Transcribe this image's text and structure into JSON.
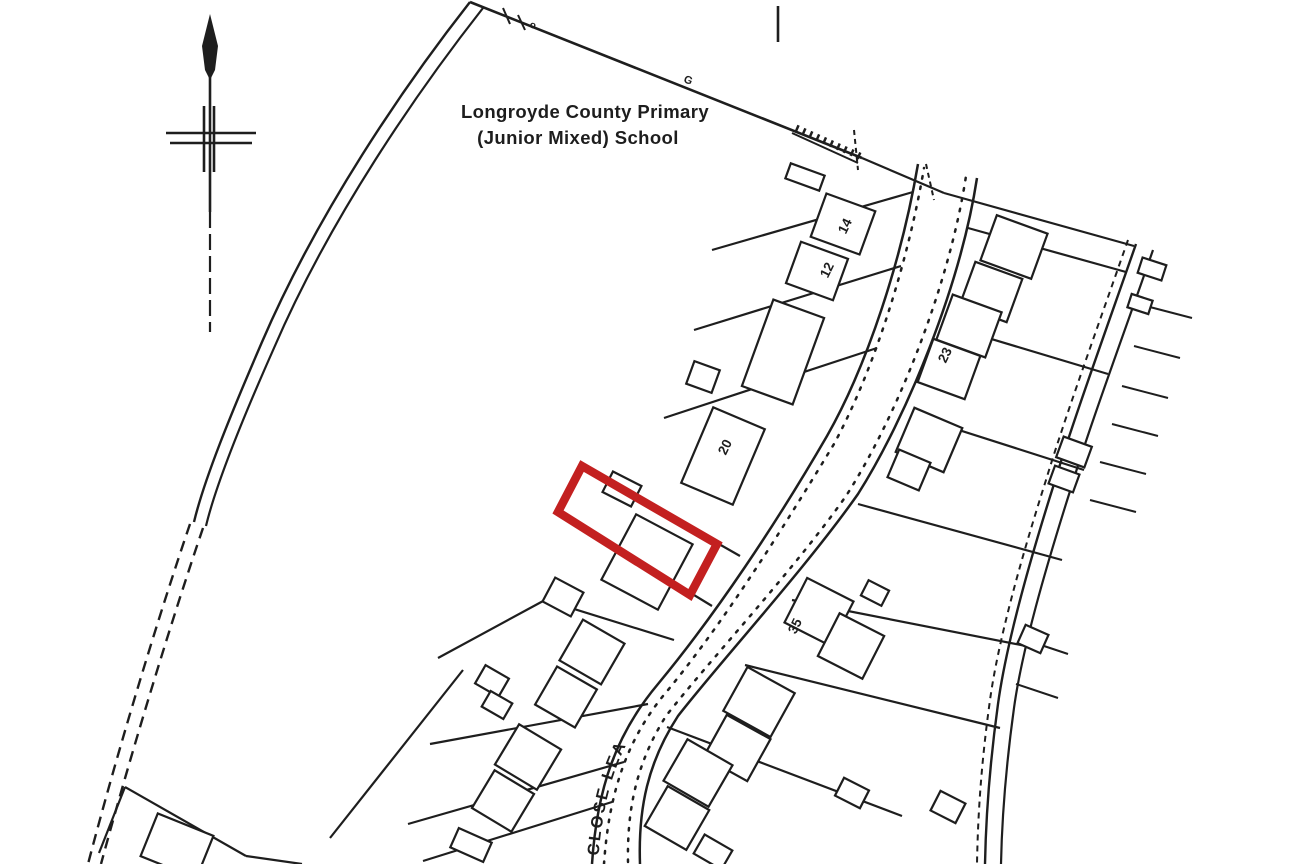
{
  "colors": {
    "ink": "#1e1e1e",
    "paper": "#ffffff",
    "highlight_red": "#c32020"
  },
  "map": {
    "school_label": {
      "line1": "Longroyde County Primary",
      "line2": "(Junior Mixed) School"
    },
    "street_label": {
      "text": "CLOSE LEA",
      "path": "M 598,862 C 603,800 614,758 645,714 C 665,689 688,667 712,649",
      "start_offset": 6
    },
    "boundary_marks": [
      {
        "text": "o",
        "x": 529,
        "y": 27,
        "rot": 20,
        "size": 10
      },
      {
        "text": "G",
        "x": 683,
        "y": 82,
        "rot": 20,
        "size": 11
      }
    ],
    "plot_numbers": [
      {
        "text": "14",
        "x": 849,
        "y": 228,
        "rot": -64
      },
      {
        "text": "12",
        "x": 831,
        "y": 272,
        "rot": -64
      },
      {
        "text": "23",
        "x": 949,
        "y": 357,
        "rot": -64
      },
      {
        "text": "20",
        "x": 729,
        "y": 449,
        "rot": -64
      },
      {
        "text": "35",
        "x": 799,
        "y": 628,
        "rot": -64
      }
    ],
    "highlight_plot": {
      "points": "582,466 717,544 690,595 558,512",
      "stroke_width": 8.5
    },
    "north_arrow": {
      "head_points": "210,14 218,46 215,70 210,80 205,70 202,46",
      "strokes": [
        {
          "name": "north-arrow-stem",
          "d": "M 210,58 L 210,212",
          "w": 2.6
        },
        {
          "name": "north-arrow-stem-lower",
          "d": "M 210,212 L 210,332",
          "w": 2.2,
          "dash": "16 6"
        },
        {
          "name": "north-arrow-cross",
          "d": "M 166,133 L 256,133",
          "w": 2.6
        },
        {
          "name": "north-arrow-cross",
          "d": "M 170,143 L 252,143",
          "w": 2.6
        },
        {
          "name": "north-arrow-cross",
          "d": "M 204,106 L 204,172",
          "w": 2.6
        },
        {
          "name": "north-arrow-cross",
          "d": "M 214,106 L 214,172",
          "w": 2.6
        }
      ]
    },
    "strokes": [
      {
        "name": "school-fence",
        "d": "M 470,2 L 862,158",
        "w": 2.6
      },
      {
        "name": "school-fence-ext",
        "d": "M 862,158 L 944,193",
        "w": 2.2
      },
      {
        "name": "fence-tick",
        "d": "M 503,8 L 510,24",
        "w": 2
      },
      {
        "name": "fence-tick",
        "d": "M 518,15 L 525,30",
        "w": 2
      },
      {
        "name": "wall-hatch-base",
        "d": "M 792,133 L 858,163",
        "w": 2
      },
      {
        "name": "wall-hatch",
        "d": "M 796,128 L 864,158",
        "w": 7,
        "dash": "2.5 5"
      },
      {
        "name": "dashed-stub",
        "d": "M 854,130 L 858,170",
        "w": 2,
        "dash": "5 4"
      },
      {
        "name": "dashed-stub",
        "d": "M 926,164 L 934,200",
        "w": 2,
        "dash": "5 4"
      },
      {
        "name": "survey-tick",
        "d": "M 778,6 L 778,42",
        "w": 2.6
      },
      {
        "name": "school-boundary-outer",
        "d": "M 470,2 C 404,86 318,212 262,342 C 230,416 204,480 194,522",
        "w": 2.4
      },
      {
        "name": "school-boundary-inner",
        "d": "M 483,8 C 417,92 330,218 274,348 C 242,420 216,484 206,526",
        "w": 2.2
      },
      {
        "name": "track-dashed",
        "d": "M 190,524 C 160,612 120,742 88,864",
        "w": 2.4,
        "dash": "11 7"
      },
      {
        "name": "track-dashed",
        "d": "M 203,528 C 173,616 133,746 101,864",
        "w": 2.4,
        "dash": "11 7"
      },
      {
        "name": "road-edge-left",
        "d": "M 592,864 C 597,788 616,734 658,684 C 716,614 776,524 827,436 C 868,364 902,258 918,164",
        "w": 2.5
      },
      {
        "name": "road-kerb-dotted",
        "d": "M 604,864 C 609,792 627,738 668,690 C 724,622 782,530 834,444 C 874,370 908,262 924,168",
        "w": 2.5,
        "dash": "2.5 8",
        "cap": "round"
      },
      {
        "name": "road-kerb-dotted",
        "d": "M 628,862 C 627,808 637,762 666,716 C 708,662 794,570 846,496 C 895,420 949,288 966,176",
        "w": 2.5,
        "dash": "2.5 8",
        "cap": "round"
      },
      {
        "name": "road-edge-right",
        "d": "M 640,864 C 638,808 648,762 678,716 C 720,662 806,568 858,494 C 906,418 960,288 977,178",
        "w": 2.5
      },
      {
        "name": "footpath-edge",
        "d": "M 1136,244 C 1106,330 1072,424 1054,484 C 1028,566 1006,646 998,704 C 990,762 986,812 985,864",
        "w": 2.4
      },
      {
        "name": "footpath-edge",
        "d": "M 1153,250 C 1123,336 1089,428 1071,488 C 1045,570 1022,650 1014,708 C 1006,766 1002,814 1001,864",
        "w": 2.2
      },
      {
        "name": "footpath-dashed",
        "d": "M 1128,240 C 1098,326 1064,420 1046,480 C 1020,562 998,642 990,700 C 982,758 978,808 977,864",
        "w": 2,
        "dash": "6 5"
      },
      {
        "name": "plot-tick",
        "d": "M 1146,306 L 1192,318",
        "w": 2
      },
      {
        "name": "plot-tick",
        "d": "M 1134,346 L 1180,358",
        "w": 2
      },
      {
        "name": "plot-tick",
        "d": "M 1122,386 L 1168,398",
        "w": 2
      },
      {
        "name": "plot-tick",
        "d": "M 1112,424 L 1158,436",
        "w": 2
      },
      {
        "name": "plot-tick",
        "d": "M 1100,462 L 1146,474",
        "w": 2
      },
      {
        "name": "plot-tick",
        "d": "M 1090,500 L 1136,512",
        "w": 2
      },
      {
        "name": "plot-tick",
        "d": "M 1026,640 L 1068,654",
        "w": 2
      },
      {
        "name": "plot-tick",
        "d": "M 1016,684 L 1058,698",
        "w": 2
      },
      {
        "name": "plot-boundary",
        "d": "M 913,192 L 712,250",
        "w": 2.2
      },
      {
        "name": "plot-boundary",
        "d": "M 901,266 L 694,330",
        "w": 2.2
      },
      {
        "name": "plot-boundary",
        "d": "M 877,348 L 664,418",
        "w": 2.2
      },
      {
        "name": "plot-boundary",
        "d": "M 582,466 L 740,556",
        "w": 2.2
      },
      {
        "name": "plot-boundary",
        "d": "M 558,512 L 712,606",
        "w": 2.2
      },
      {
        "name": "plot-boundary",
        "d": "M 674,640 L 545,600 L 438,658",
        "w": 2.2
      },
      {
        "name": "plot-boundary",
        "d": "M 648,704 L 430,744",
        "w": 2.2
      },
      {
        "name": "plot-boundary",
        "d": "M 624,762 L 408,824",
        "w": 2.2
      },
      {
        "name": "plot-boundary",
        "d": "M 612,802 L 423,861",
        "w": 2.2
      },
      {
        "name": "plot-boundary",
        "d": "M 463,670 L 330,838",
        "w": 2.2
      },
      {
        "name": "plot-boundary",
        "d": "M 125,787 L 99,853",
        "w": 2.2
      },
      {
        "name": "plot-boundary",
        "d": "M 125,787 L 246,856",
        "w": 2.2
      },
      {
        "name": "plot-boundary",
        "d": "M 246,856 L 302,864",
        "w": 2.2
      },
      {
        "name": "plot-boundary",
        "d": "M 944,193 L 1134,246",
        "w": 2.2
      },
      {
        "name": "plot-boundary",
        "d": "M 968,228 L 1126,272",
        "w": 2.2
      },
      {
        "name": "plot-boundary",
        "d": "M 948,326 L 1108,374",
        "w": 2.2
      },
      {
        "name": "plot-boundary",
        "d": "M 915,416 L 1084,470",
        "w": 2.2
      },
      {
        "name": "plot-boundary",
        "d": "M 858,504 L 1062,560",
        "w": 2.2
      },
      {
        "name": "plot-boundary",
        "d": "M 792,600 L 1036,648",
        "w": 2.2
      },
      {
        "name": "plot-boundary",
        "d": "M 745,665 L 1000,728",
        "w": 2.2
      },
      {
        "name": "plot-boundary",
        "d": "M 667,727 L 902,816",
        "w": 2.2
      }
    ],
    "buildings": [
      {
        "cx": 805,
        "cy": 177,
        "w": 36,
        "h": 16,
        "rot": 20
      },
      {
        "cx": 843,
        "cy": 224,
        "w": 52,
        "h": 46,
        "rot": 20
      },
      {
        "cx": 817,
        "cy": 271,
        "w": 50,
        "h": 44,
        "rot": 20
      },
      {
        "cx": 783,
        "cy": 352,
        "w": 54,
        "h": 92,
        "rot": 20
      },
      {
        "cx": 703,
        "cy": 377,
        "w": 27,
        "h": 24,
        "rot": 20
      },
      {
        "cx": 723,
        "cy": 456,
        "w": 56,
        "h": 82,
        "rot": 23
      },
      {
        "cx": 622,
        "cy": 489,
        "w": 32,
        "h": 23,
        "rot": 27
      },
      {
        "cx": 647,
        "cy": 562,
        "w": 64,
        "h": 74,
        "rot": 28
      },
      {
        "cx": 563,
        "cy": 597,
        "w": 32,
        "h": 27,
        "rot": 28
      },
      {
        "cx": 592,
        "cy": 652,
        "w": 48,
        "h": 47,
        "rot": 30
      },
      {
        "cx": 566,
        "cy": 697,
        "w": 46,
        "h": 44,
        "rot": 30
      },
      {
        "cx": 492,
        "cy": 681,
        "w": 27,
        "h": 21,
        "rot": 30
      },
      {
        "cx": 497,
        "cy": 705,
        "w": 25,
        "h": 18,
        "rot": 30
      },
      {
        "cx": 528,
        "cy": 757,
        "w": 49,
        "h": 47,
        "rot": 31
      },
      {
        "cx": 503,
        "cy": 801,
        "w": 46,
        "h": 44,
        "rot": 31
      },
      {
        "cx": 471,
        "cy": 845,
        "w": 36,
        "h": 21,
        "rot": 24
      },
      {
        "cx": 177,
        "cy": 846,
        "w": 60,
        "h": 46,
        "rot": 22
      },
      {
        "cx": 1014,
        "cy": 247,
        "w": 54,
        "h": 48,
        "rot": 20
      },
      {
        "cx": 991,
        "cy": 292,
        "w": 50,
        "h": 46,
        "rot": 20
      },
      {
        "cx": 969,
        "cy": 326,
        "w": 52,
        "h": 48,
        "rot": 20
      },
      {
        "cx": 949,
        "cy": 369,
        "w": 50,
        "h": 46,
        "rot": 20
      },
      {
        "cx": 929,
        "cy": 440,
        "w": 52,
        "h": 48,
        "rot": 23
      },
      {
        "cx": 909,
        "cy": 470,
        "w": 34,
        "h": 30,
        "rot": 23
      },
      {
        "cx": 1074,
        "cy": 452,
        "w": 30,
        "h": 22,
        "rot": 20
      },
      {
        "cx": 1064,
        "cy": 479,
        "w": 26,
        "h": 19,
        "rot": 20
      },
      {
        "cx": 819,
        "cy": 612,
        "w": 52,
        "h": 50,
        "rot": 27
      },
      {
        "cx": 851,
        "cy": 646,
        "w": 50,
        "h": 48,
        "rot": 27
      },
      {
        "cx": 875,
        "cy": 593,
        "w": 23,
        "h": 17,
        "rot": 27
      },
      {
        "cx": 759,
        "cy": 702,
        "w": 54,
        "h": 50,
        "rot": 29
      },
      {
        "cx": 737,
        "cy": 748,
        "w": 50,
        "h": 48,
        "rot": 29
      },
      {
        "cx": 698,
        "cy": 773,
        "w": 52,
        "h": 48,
        "rot": 30
      },
      {
        "cx": 677,
        "cy": 818,
        "w": 48,
        "h": 46,
        "rot": 30
      },
      {
        "cx": 713,
        "cy": 852,
        "w": 32,
        "h": 22,
        "rot": 30
      },
      {
        "cx": 852,
        "cy": 793,
        "w": 28,
        "h": 20,
        "rot": 27
      },
      {
        "cx": 1152,
        "cy": 269,
        "w": 25,
        "h": 16,
        "rot": 18
      },
      {
        "cx": 1140,
        "cy": 304,
        "w": 22,
        "h": 14,
        "rot": 18
      },
      {
        "cx": 1033,
        "cy": 639,
        "w": 25,
        "h": 20,
        "rot": 24
      },
      {
        "cx": 948,
        "cy": 807,
        "w": 28,
        "h": 22,
        "rot": 27
      }
    ]
  }
}
